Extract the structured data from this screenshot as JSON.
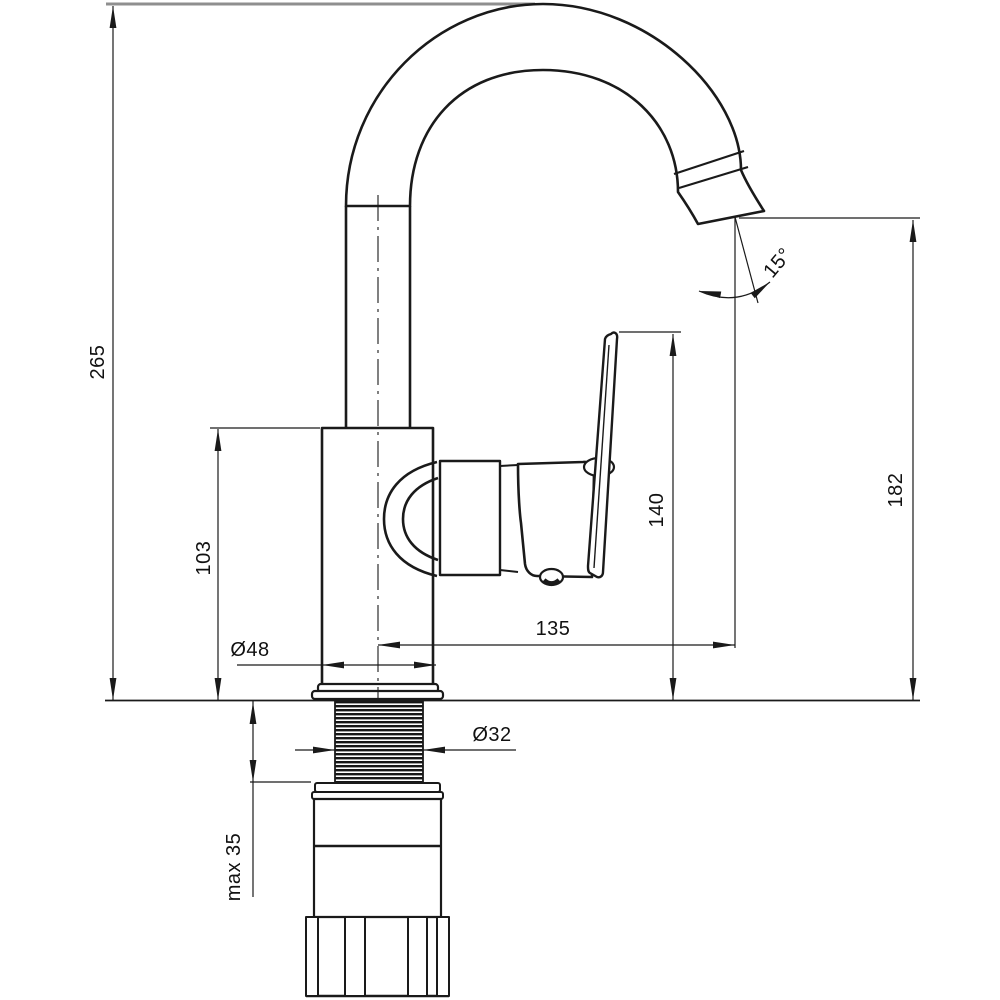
{
  "drawing": {
    "subject": "single-lever-mixer-faucet-dimension-drawing",
    "background_color": "#ffffff",
    "line_color": "#1a1a1a",
    "light_line_color": "#8f8f8f",
    "dimensions": {
      "total_height": "265",
      "spout_column_height": "103",
      "handle_top_height": "140",
      "outlet_height": "182",
      "spout_reach": "135",
      "base_diameter": "Ø48",
      "shank_diameter": "Ø32",
      "max_mounting_thickness": "max 35",
      "outlet_angle": "15°"
    }
  }
}
